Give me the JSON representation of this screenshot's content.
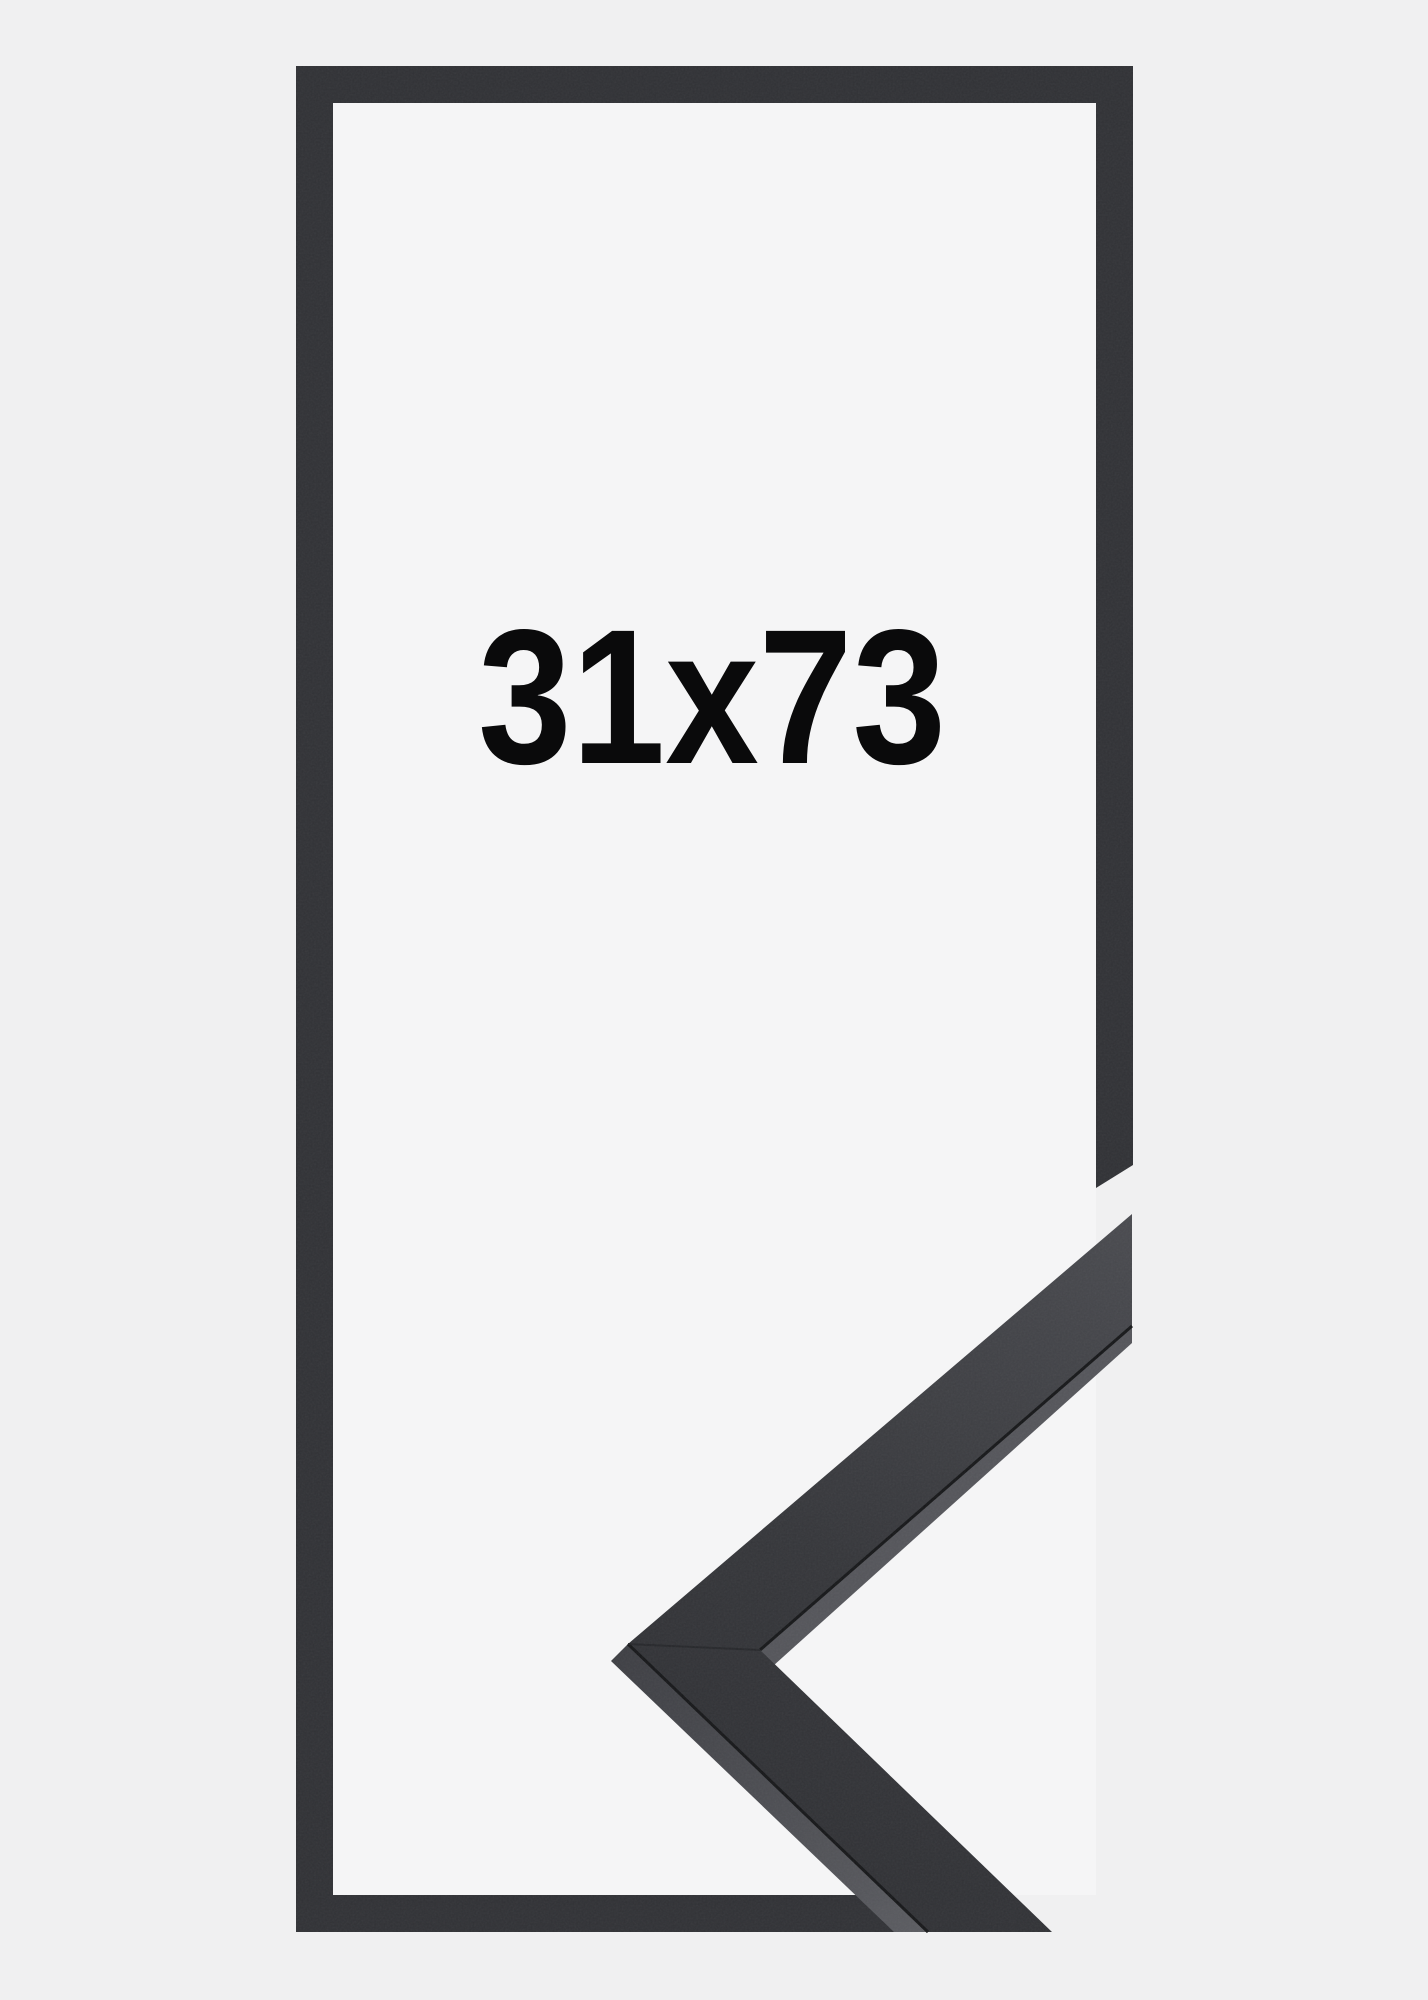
{
  "product_image": {
    "size_label": "31x73",
    "description": "black picture frame outline with corner sample"
  },
  "colors": {
    "background": "#f0f0f1",
    "frame_interior": "#f5f5f6",
    "frame_outline": "#313236",
    "moulding_face_light": "#4a4b50",
    "moulding_face_dark": "#2f3034",
    "moulding_side_outer": "#4c4d52",
    "moulding_side_outer_deep": "#3e3f44",
    "moulding_side_inner": "#55565b",
    "seam": "#17181a",
    "miter_seam": "#26272a",
    "size_text": "#0a0a0b"
  }
}
